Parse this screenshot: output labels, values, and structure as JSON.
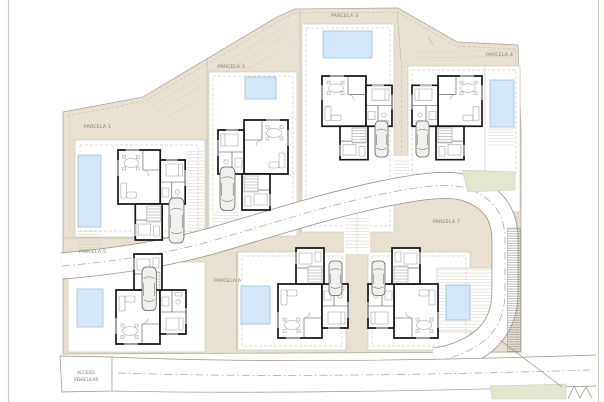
{
  "site": {
    "parcels": [
      {
        "label": "PARCELA 1"
      },
      {
        "label": "PARCELA 2"
      },
      {
        "label": "PARCELA 3"
      },
      {
        "label": "PARCELA 4"
      },
      {
        "label": "PARCELA 5"
      },
      {
        "label": "PARCELA 6"
      },
      {
        "label": "PARCELA 7"
      }
    ],
    "access_road": {
      "line1": "ACCESO",
      "line2": "VEHICULAR"
    }
  },
  "palette": {
    "terrain": "#e8e1d1",
    "pool": "#d3e7f8",
    "green": "#e3e7d0",
    "road": "#ffffff",
    "wall": "#161616",
    "label_text": "#7d7668"
  }
}
